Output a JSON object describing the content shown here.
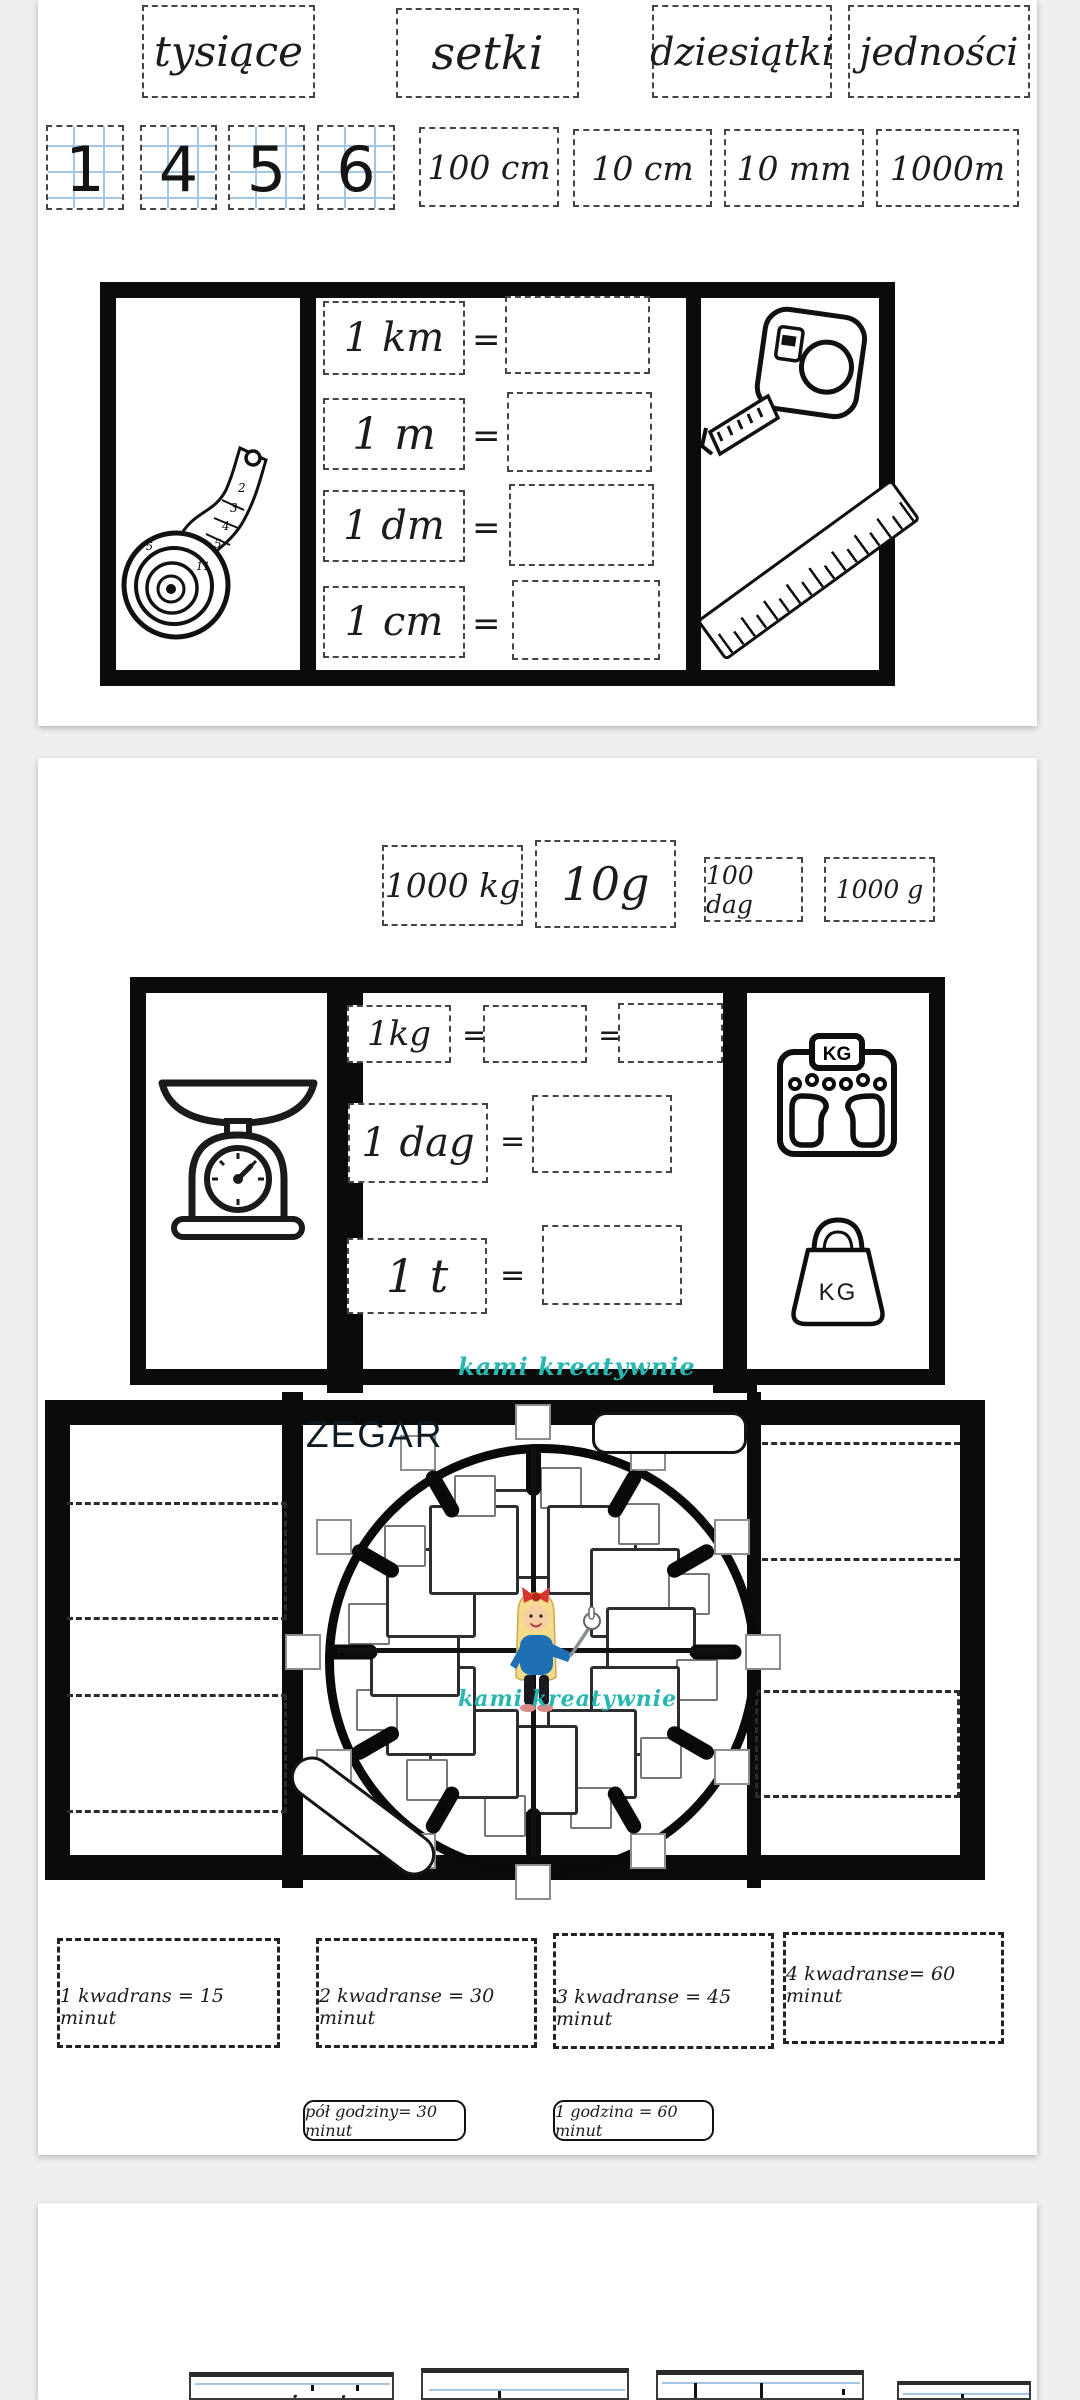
{
  "colors": {
    "accent_teal": "#29b7b2",
    "canvas_bg": "#edeff1",
    "frame_black": "#0b0b0b",
    "guide_blue": "#a6c4e4"
  },
  "page1": {
    "place_values": [
      "tysiące",
      "setki",
      "dziesiątki",
      "jedności"
    ],
    "digits": [
      "1",
      "4",
      "5",
      "6"
    ],
    "measure_cards": [
      "100 cm",
      "10 cm",
      "10 mm",
      "1000m"
    ],
    "length_table": {
      "eq": "=",
      "rows": [
        {
          "label": "1 km"
        },
        {
          "label": "1 m"
        },
        {
          "label": "1 dm"
        },
        {
          "label": "1 cm"
        }
      ]
    }
  },
  "page2": {
    "mass_cards": [
      "1000 kg",
      "10g",
      "100 dag",
      "1000 g"
    ],
    "mass_table": {
      "eq": "=",
      "rows": [
        {
          "label": "1kg"
        },
        {
          "label": "1 dag"
        },
        {
          "label": "1 t"
        }
      ]
    },
    "watermark": "kami kreatywnie",
    "clock": {
      "title": "ZEGAR",
      "watermark": "kami kreatywnie"
    },
    "weight_icons": {
      "bathroom_scale_label": "KG",
      "kettlebell_label": "KG"
    },
    "time_facts": [
      "1 kwadrans = 15 minut",
      "2 kwadranse = 30 minut",
      "3 kwadranse = 45 minut",
      "4 kwadranse= 60 minut"
    ],
    "time_pills": [
      "pół godziny= 30 minut",
      "1 godzina = 60 minut"
    ]
  },
  "page3": {
    "partial_labels": [
      "mnożenie"
    ]
  }
}
